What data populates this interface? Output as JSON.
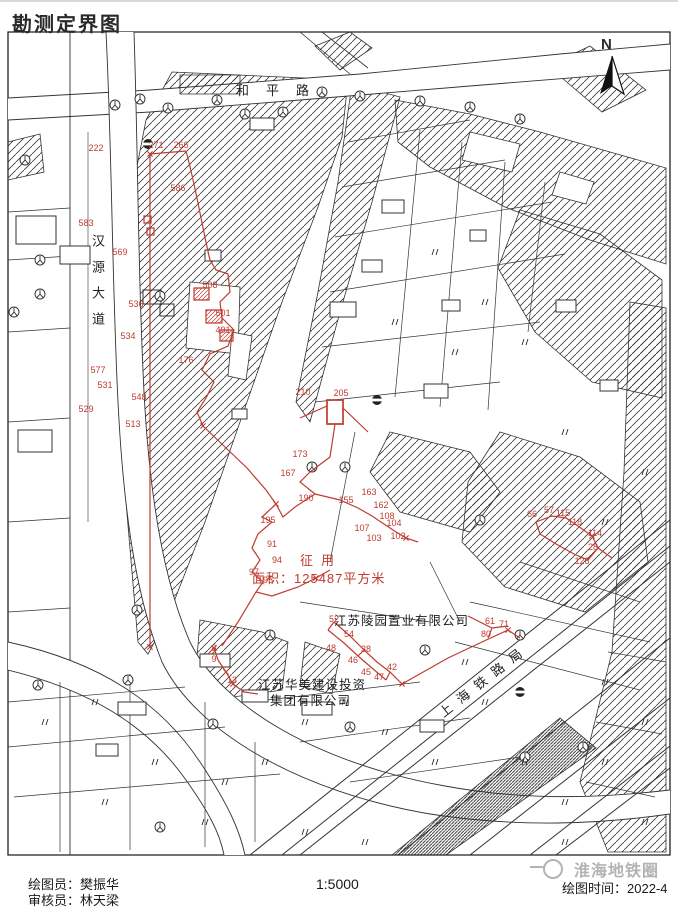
{
  "page": {
    "title": "勘测定界图"
  },
  "compass": {
    "label": "N"
  },
  "roads": {
    "heping": "和平路",
    "hanyuan": "汉源大道",
    "shanghai_railway": "上海铁路局"
  },
  "parcel": {
    "action_label": "征用",
    "area_label": "面积：125487平方米"
  },
  "companies": {
    "lingyuan": "江苏陵园置业有限公司",
    "huamei_line1": "江苏华美建设投资",
    "huamei_line2": "集团有限公司"
  },
  "footer": {
    "drafter": "绘图员：樊振华",
    "reviewer": "审核员：林天梁",
    "scale": "1:5000",
    "time": "绘图时间：2022-4"
  },
  "watermark": {
    "text": "淮海地铁圈"
  },
  "colors": {
    "boundary": "#c03b30",
    "ink": "#2a2a2a",
    "watermark": "#b3b3b3"
  },
  "point_labels": [
    {
      "t": "222",
      "x": 96,
      "y": 146
    },
    {
      "t": "271",
      "x": 156,
      "y": 143
    },
    {
      "t": "266",
      "x": 181,
      "y": 143
    },
    {
      "t": "583",
      "x": 86,
      "y": 221
    },
    {
      "t": "586",
      "x": 178,
      "y": 186
    },
    {
      "t": "569",
      "x": 120,
      "y": 250
    },
    {
      "t": "508",
      "x": 210,
      "y": 283
    },
    {
      "t": "501",
      "x": 223,
      "y": 311
    },
    {
      "t": "491",
      "x": 223,
      "y": 328
    },
    {
      "t": "536",
      "x": 136,
      "y": 302
    },
    {
      "t": "534",
      "x": 128,
      "y": 334
    },
    {
      "t": "176",
      "x": 186,
      "y": 358
    },
    {
      "t": "577",
      "x": 98,
      "y": 368
    },
    {
      "t": "531",
      "x": 105,
      "y": 383
    },
    {
      "t": "548",
      "x": 139,
      "y": 395
    },
    {
      "t": "529",
      "x": 86,
      "y": 407
    },
    {
      "t": "513",
      "x": 133,
      "y": 422
    },
    {
      "t": "210",
      "x": 303,
      "y": 390
    },
    {
      "t": "205",
      "x": 341,
      "y": 391
    },
    {
      "t": "173",
      "x": 300,
      "y": 452
    },
    {
      "t": "167",
      "x": 288,
      "y": 471
    },
    {
      "t": "190",
      "x": 306,
      "y": 496
    },
    {
      "t": "195",
      "x": 268,
      "y": 518
    },
    {
      "t": "91",
      "x": 272,
      "y": 542
    },
    {
      "t": "94",
      "x": 277,
      "y": 558
    },
    {
      "t": "97",
      "x": 254,
      "y": 570
    },
    {
      "t": "95",
      "x": 268,
      "y": 578
    },
    {
      "t": "155",
      "x": 346,
      "y": 498
    },
    {
      "t": "163",
      "x": 369,
      "y": 490
    },
    {
      "t": "162",
      "x": 381,
      "y": 503
    },
    {
      "t": "108",
      "x": 387,
      "y": 514
    },
    {
      "t": "104",
      "x": 394,
      "y": 521
    },
    {
      "t": "107",
      "x": 362,
      "y": 526
    },
    {
      "t": "103",
      "x": 374,
      "y": 536
    },
    {
      "t": "102",
      "x": 398,
      "y": 534
    },
    {
      "t": "66",
      "x": 532,
      "y": 512
    },
    {
      "t": "57",
      "x": 549,
      "y": 508
    },
    {
      "t": "115",
      "x": 563,
      "y": 511
    },
    {
      "t": "118",
      "x": 575,
      "y": 520
    },
    {
      "t": "114",
      "x": 595,
      "y": 531
    },
    {
      "t": "28",
      "x": 593,
      "y": 545
    },
    {
      "t": "128",
      "x": 582,
      "y": 559
    },
    {
      "t": "61",
      "x": 490,
      "y": 619
    },
    {
      "t": "71",
      "x": 504,
      "y": 622
    },
    {
      "t": "80",
      "x": 486,
      "y": 632
    },
    {
      "t": "52",
      "x": 334,
      "y": 617
    },
    {
      "t": "54",
      "x": 349,
      "y": 632
    },
    {
      "t": "48",
      "x": 331,
      "y": 646
    },
    {
      "t": "38",
      "x": 366,
      "y": 647
    },
    {
      "t": "46",
      "x": 353,
      "y": 658
    },
    {
      "t": "45",
      "x": 366,
      "y": 670
    },
    {
      "t": "42",
      "x": 392,
      "y": 665
    },
    {
      "t": "47",
      "x": 379,
      "y": 675
    },
    {
      "t": "8",
      "x": 214,
      "y": 646
    },
    {
      "t": "9",
      "x": 214,
      "y": 657
    },
    {
      "t": "13",
      "x": 232,
      "y": 678
    }
  ]
}
